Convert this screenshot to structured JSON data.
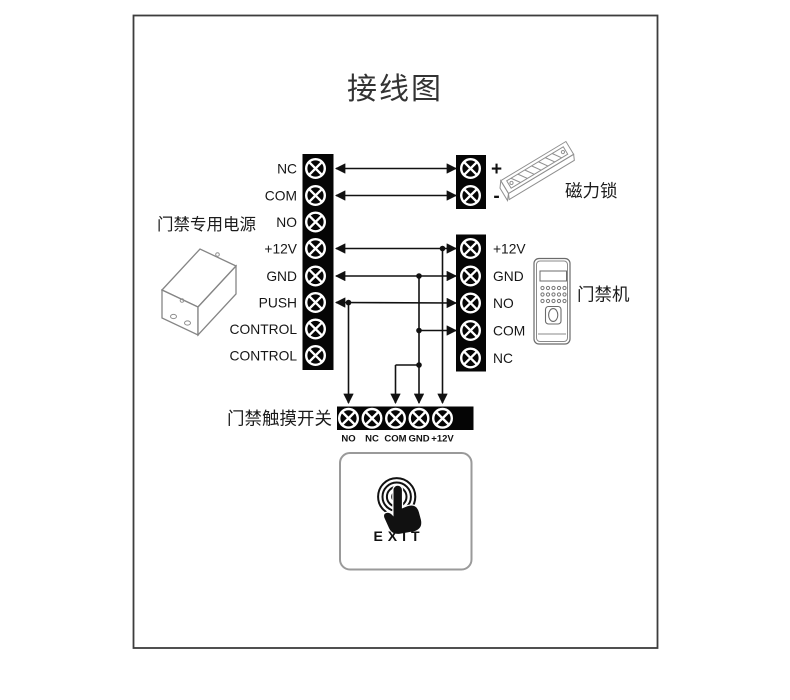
{
  "title": "接线图",
  "power_supply": {
    "label": "门禁专用电源",
    "terminals": [
      "NC",
      "COM",
      "NO",
      "+12V",
      "GND",
      "PUSH",
      "CONTROL",
      "CONTROL"
    ]
  },
  "maglock": {
    "label": "磁力锁",
    "terminals": [
      "+",
      "-"
    ]
  },
  "access_controller": {
    "label": "门禁机",
    "terminals": [
      "+12V",
      "GND",
      "NO",
      "COM",
      "NC"
    ]
  },
  "touch_switch": {
    "label": "门禁触摸开关",
    "terminals": [
      "NO",
      "NC",
      "COM",
      "GND",
      "+12V"
    ]
  },
  "exit_button": {
    "label": "EXIT"
  },
  "connections": [
    "电源 NC → 磁力锁 +",
    "电源 COM → 磁力锁 -",
    "电源 +12V → 门禁机 +12V / 开关 +12V",
    "电源 GND → 门禁机 GND / 门禁机 COM / 开关 GND / 开关 COM",
    "电源 PUSH → 门禁机 NO / 开关 NO"
  ],
  "colors": {
    "line": "#111111",
    "block": "#050505",
    "icon_stroke": "#858585",
    "background": "#ffffff"
  }
}
